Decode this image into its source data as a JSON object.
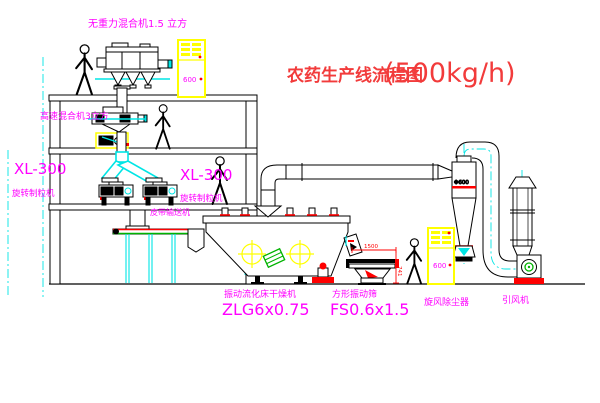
{
  "title": {
    "text": "农药生产线流程图",
    "capacity": "(500kg/h)"
  },
  "labels": {
    "gravity_mixer": "无重力混合机1.5 立方",
    "high_speed_mixer": "高速混合机3立方",
    "granulator_left": {
      "model": "XL-300",
      "name": "旋转制粒机"
    },
    "granulator_right": {
      "model": "XL-300",
      "name": "旋转制粒机"
    },
    "belt_conveyor": "皮带输送机",
    "dryer": {
      "name": "振动流化床干燥机",
      "model": "ZLG6x0.75"
    },
    "screen": {
      "name": "方形振动筛",
      "model": "FS0.6x1.5",
      "dim_width": "1500",
      "dim_height": "741"
    },
    "cyclone": {
      "name": "旋风除尘器",
      "dia": "Φ600"
    },
    "fan": {
      "name": "引风机"
    },
    "cabinet_top": "600",
    "cabinet_right": "600"
  },
  "colors": {
    "label": "#ff00ff",
    "title": "#f23b3b",
    "centerline": "#00e5e5",
    "cabinet": "#ffff00",
    "accent_red": "#ff0000",
    "accent_green": "#00b300",
    "line": "#000000"
  }
}
